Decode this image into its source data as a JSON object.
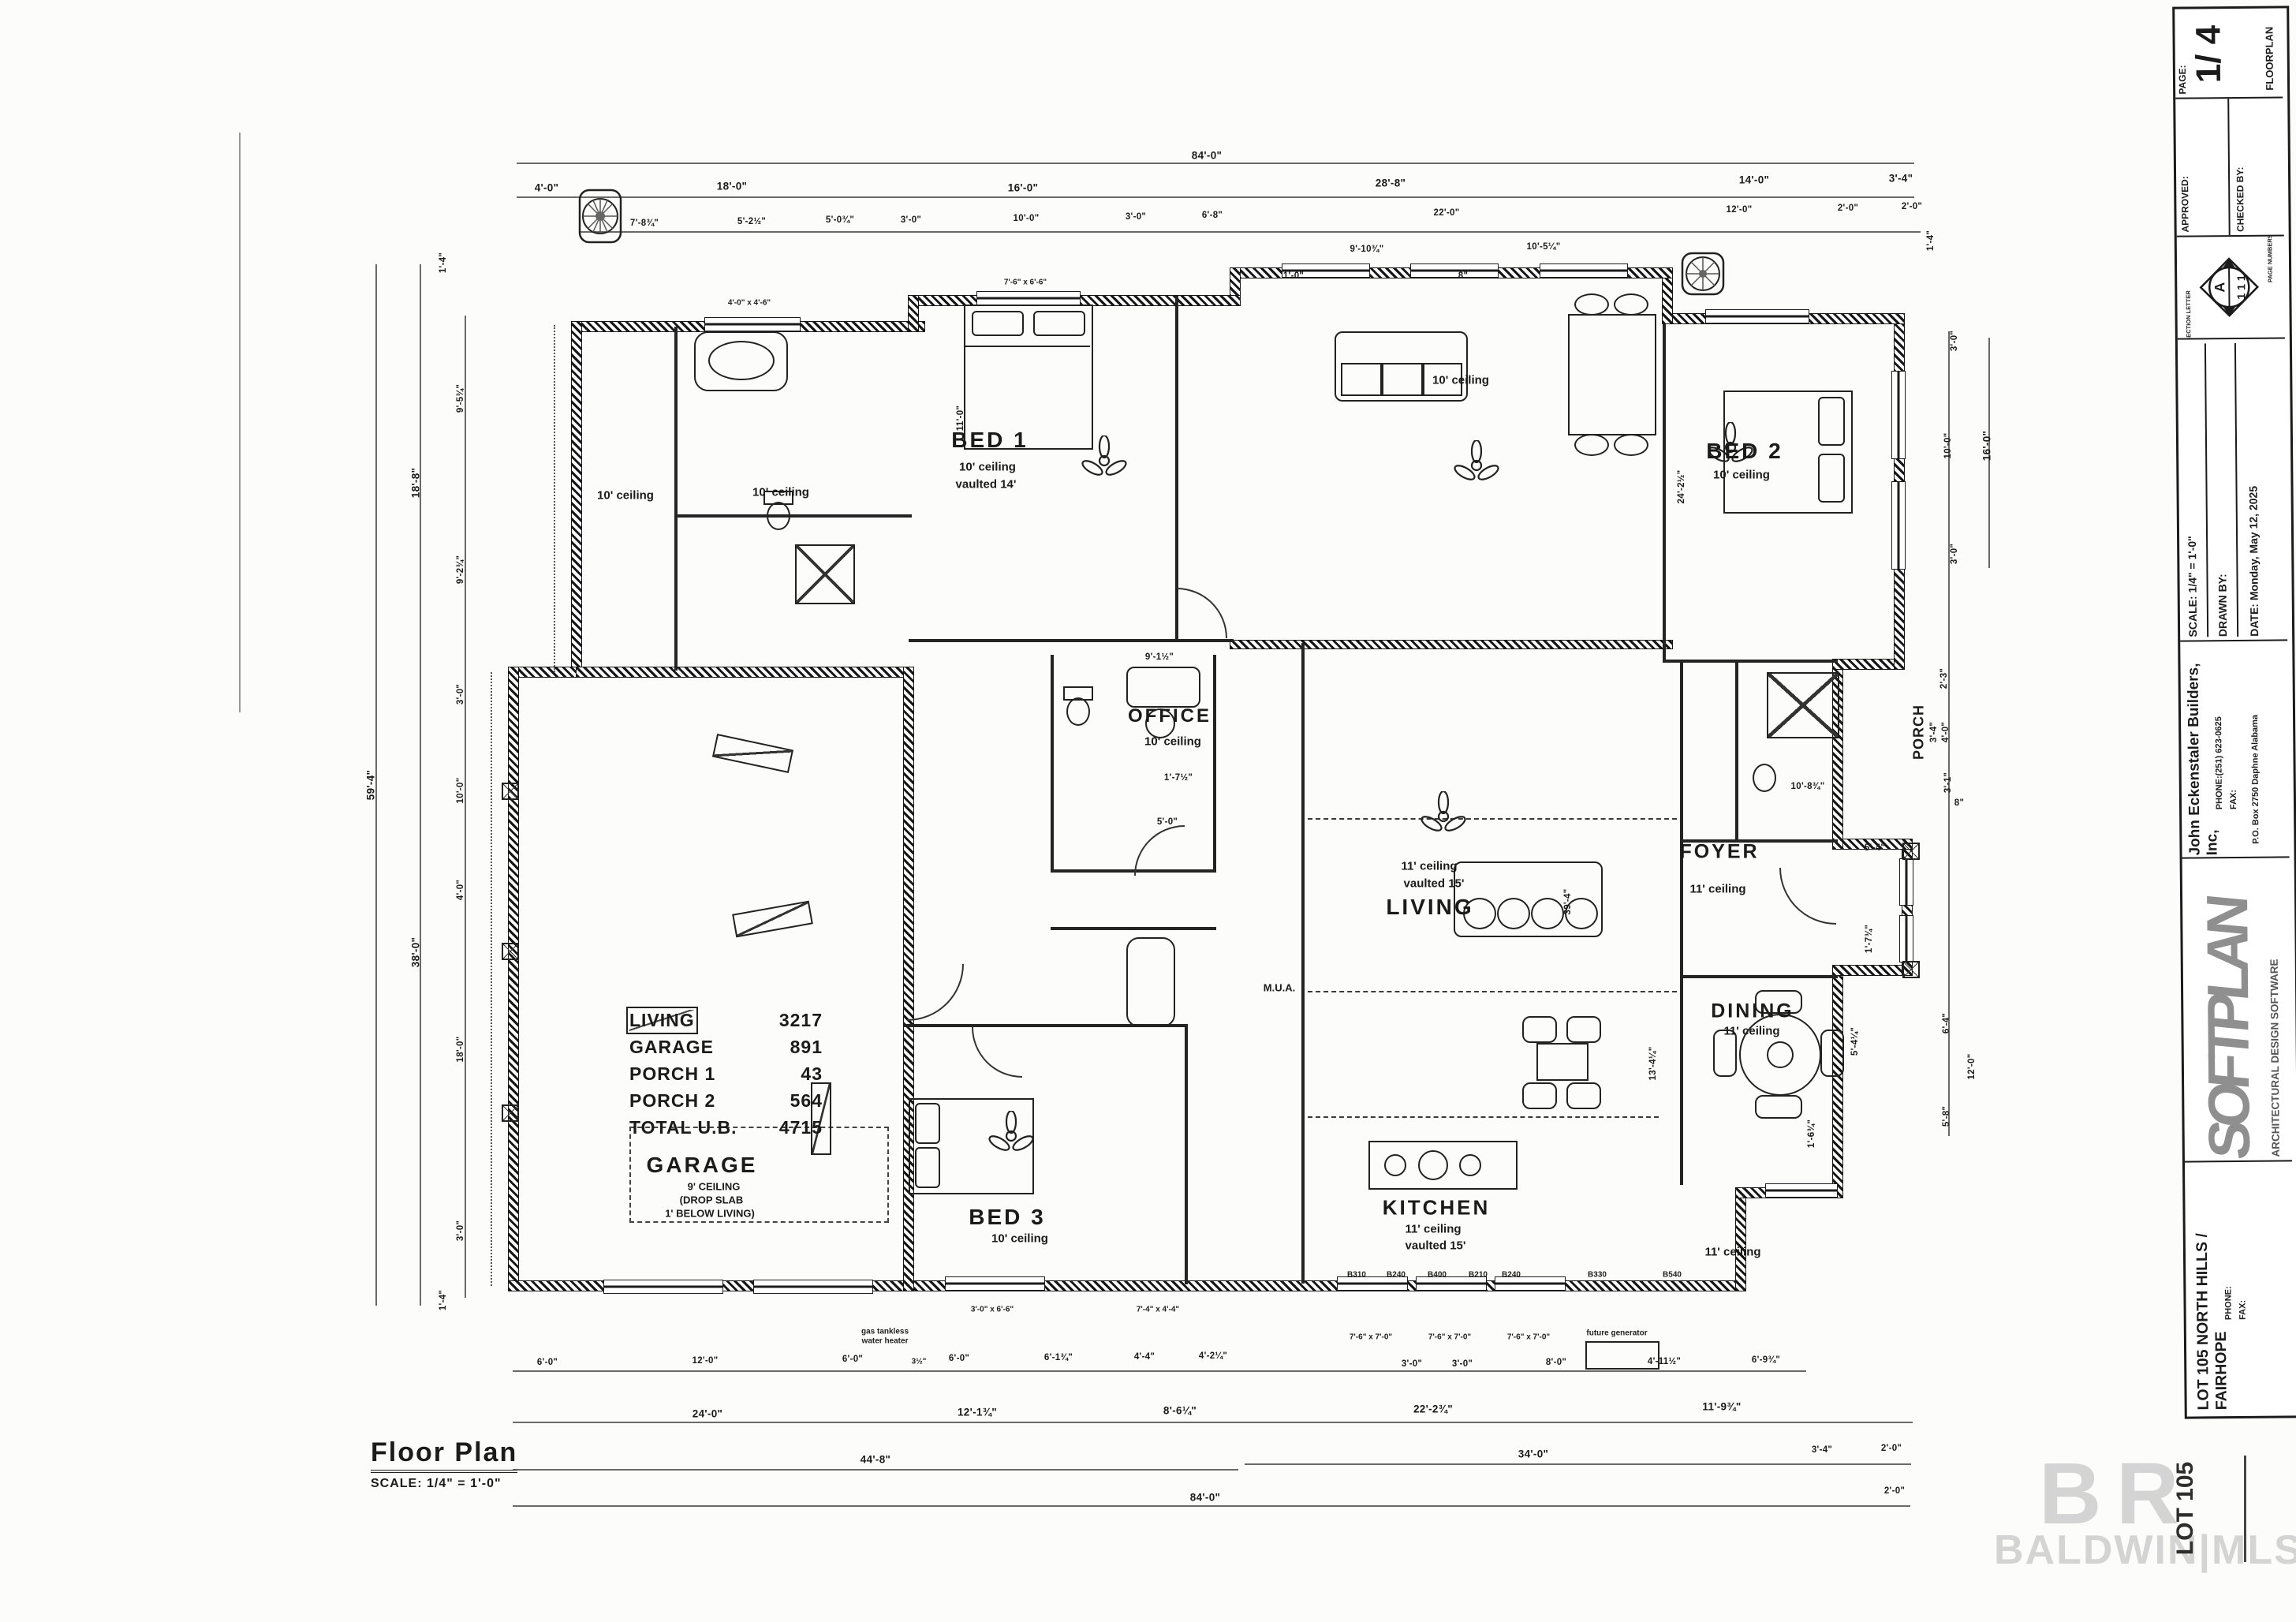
{
  "title_block": {
    "page_label": "PAGE:",
    "page_value": "1/ 4",
    "sheet_type": "FLOORPLAN",
    "approved": "APPROVED:",
    "checked_by": "CHECKED BY:",
    "section_letter_label": "SECTION LETTER",
    "page_numbers_label": "PAGE NUMBERS",
    "section_letter": "A",
    "page_numbers": "1 1 1",
    "scale": "SCALE:  1/4\" = 1'-0\"",
    "drawn_by": "DRAWN BY:",
    "date": "DATE:  Monday, May 12, 2025",
    "company": "John Eckenstaler Builders, Inc,",
    "company_phone": "PHONE:(251) 623-0625",
    "company_fax": "FAX:",
    "company_address": "P.O. Box 2750   Daphne   Alabama",
    "softplan": "SOFTPLAN",
    "softplan_sub": "ARCHITECTURAL DESIGN SOFTWARE",
    "project": "LOT 105 NORTH HILLS / FAIRHOPE",
    "project_phone": "PHONE:",
    "project_fax": "FAX:"
  },
  "footer": {
    "title": "Floor Plan",
    "scale": "SCALE: 1/4\" = 1'-0\""
  },
  "watermark": {
    "logo": "B R",
    "text": "BALDWIN|MLS",
    "stamp": "LOT 105"
  },
  "area_table": [
    {
      "label": "LIVING",
      "value": "3217"
    },
    {
      "label": "GARAGE",
      "value": "891"
    },
    {
      "label": "PORCH 1",
      "value": "43"
    },
    {
      "label": "PORCH 2",
      "value": "564"
    },
    {
      "label": "TOTAL U.B.",
      "value": "4715"
    }
  ],
  "rooms": {
    "bed1": {
      "name": "BED 1",
      "l1": "10' ceiling",
      "l2": "vaulted 14'"
    },
    "bed2": {
      "name": "BED 2",
      "l1": "10' ceiling"
    },
    "bed3": {
      "name": "BED 3",
      "l1": "10' ceiling"
    },
    "office": {
      "name": "OFFICE",
      "l1": "10' ceiling"
    },
    "living": {
      "name": "LIVING",
      "l1": "11' ceiling",
      "l2": "vaulted 15'"
    },
    "kitchen": {
      "name": "KITCHEN",
      "l1": "11' ceiling",
      "l2": "vaulted 15'"
    },
    "dining": {
      "name": "DINING",
      "l1": "11' ceiling"
    },
    "foyer": {
      "name": "FOYER",
      "l1": "11' ceiling"
    },
    "garage": {
      "name": "GARAGE",
      "l1": "9' CEILING",
      "l2": "(DROP SLAB",
      "l3": "1' BELOW LIVING)"
    },
    "porch": {
      "name": "PORCH",
      "dim": "3'-4\""
    },
    "porch2_ceiling": "10' ceiling",
    "bath1_ceiling": "10' ceiling",
    "bath2_ceiling": "10' ceiling",
    "rear_ceiling": "11' ceiling",
    "mua": "M.U.A."
  },
  "labels": {
    "future_generator": "future generator",
    "gas_tankless": "gas tankless",
    "water_heater": "water heater",
    "offset": "3½\"",
    "win1": "4'-0\" x 4'-6\"",
    "win2": "7'-6\" x 6'-6\"",
    "win3a": "7'-6\" x 7'-0\"",
    "win3b": "7'-6\" x 7'-0\"",
    "win3c": "7'-6\" x 7'-0\"",
    "win4": "3'-0\" x 6'-6\"",
    "win5": "7'-4\" x 4'-4\"",
    "cab0": "B310",
    "cab1": "B240",
    "cab2": "B400",
    "cab3": "B210",
    "cab4": "B240",
    "cab5": "B330",
    "cab6": "B540"
  },
  "dims": {
    "t": [
      "84'-0\"",
      "4'-0\"",
      "18'-0\"",
      "16'-0\"",
      "28'-8\"",
      "14'-0\"",
      "3'-4\"",
      "7'-8¾\"",
      "5'-2½\"",
      "5'-0¾\"",
      "3'-0\"",
      "10'-0\"",
      "3'-0\"",
      "6'-8\"",
      "22'-0\"",
      "12'-0\"",
      "2'-0\"",
      "2'-0\"",
      "9'-10¾\"",
      "10'-5¼\"",
      "1'-0\"",
      "8\"",
      "1'-4\""
    ],
    "b": [
      "6'-0\"",
      "12'-0\"",
      "6'-0\"",
      "6'-0\"",
      "6'-1¾\"",
      "4'-4\"",
      "4'-2¼\"",
      "3'-0\"",
      "3'-0\"",
      "8'-0\"",
      "4'-11½\"",
      "6'-9¾\"",
      "24'-0\"",
      "12'-1¾\"",
      "8'-6¼\"",
      "22'-2¾\"",
      "11'-9¾\"",
      "44'-8\"",
      "34'-0\"",
      "84'-0\"",
      "3'-4\"",
      "2'-0\"",
      "2'-0\""
    ],
    "l": [
      "59'-4\"",
      "18'-8\"",
      "38'-0\"",
      "1'-4\"",
      "9'-5¾\"",
      "9'-2¾\"",
      "3'-0\"",
      "10'-0\"",
      "4'-0\"",
      "18'-0\"",
      "3'-0\"",
      "1'-4\"",
      "11'-0\""
    ],
    "r": [
      "3'-0\"",
      "10'-0\"",
      "3'-0\"",
      "16'-0\"",
      "2'-3\"",
      "4'-0\"",
      "3'-1\"",
      "8\"",
      "10'-8¾\"",
      "12'-0\"",
      "6'-4\"",
      "5'-8\"",
      "5'-4\"",
      "5'-4¼\"",
      "1'-7¾\"",
      "24'-2½\"",
      "39'-4\"",
      "13'-4¼\"",
      "1'-6¾\""
    ],
    "i": [
      "9'-1½\"",
      "5'-0\"",
      "1'-7½\""
    ]
  }
}
